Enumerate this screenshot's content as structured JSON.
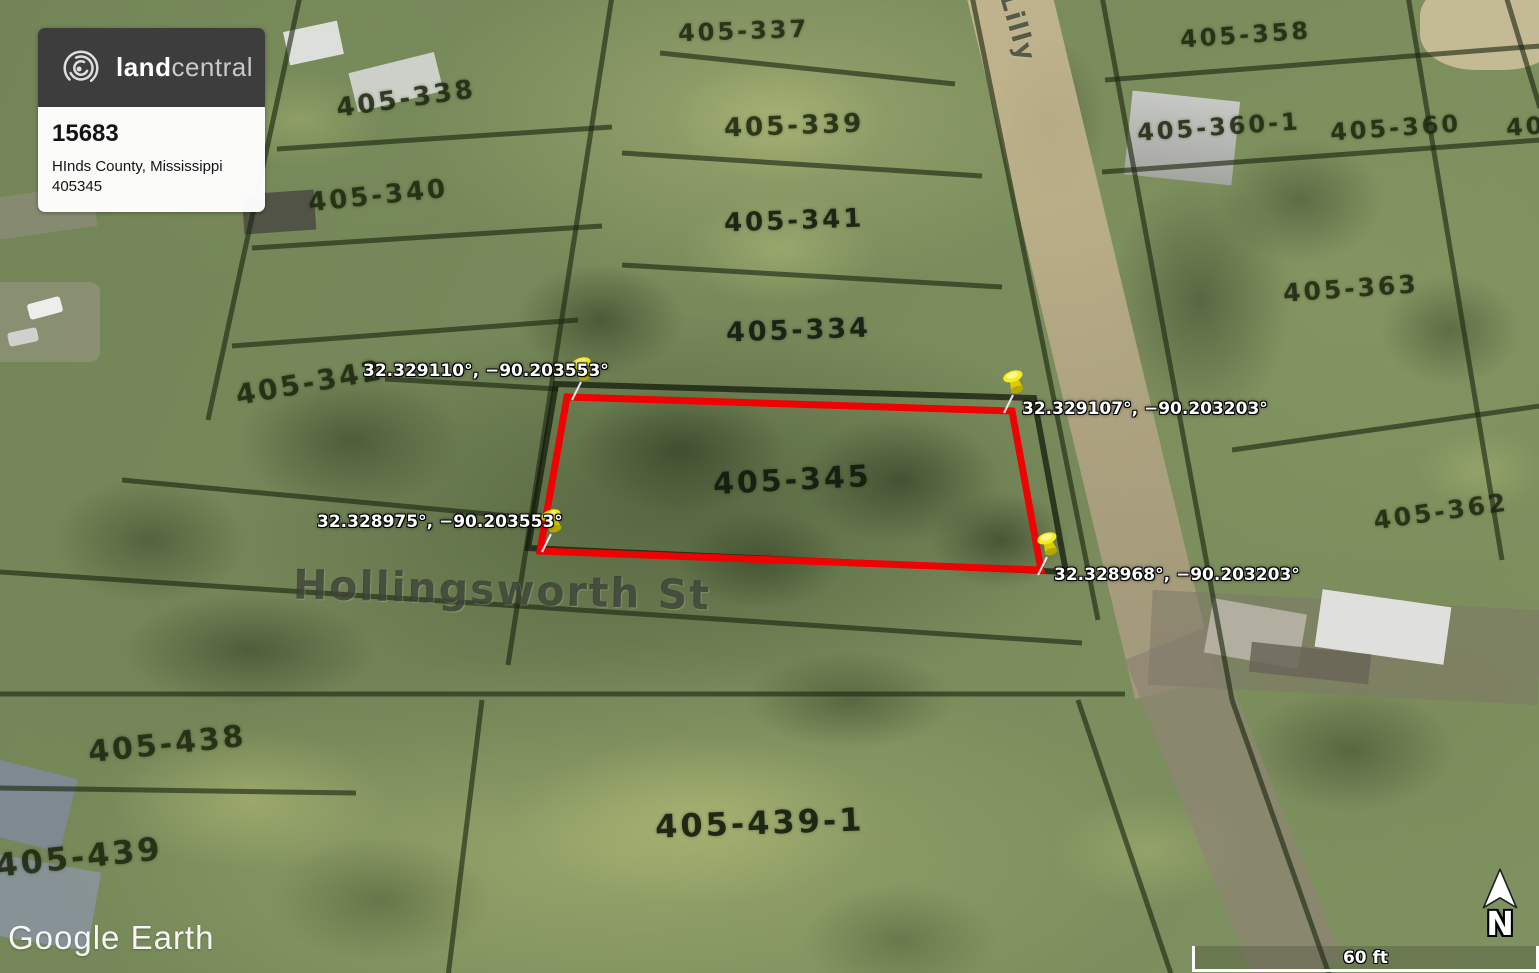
{
  "branding_card": {
    "logo_bold": "land",
    "logo_light": "central",
    "listing_id": "15683",
    "location": "HInds County, Mississippi",
    "apn": "405345"
  },
  "pins": [
    {
      "position": "top-left",
      "coords": "32.329110°, −90.203553°"
    },
    {
      "position": "top-right",
      "coords": "32.329107°, −90.203203°"
    },
    {
      "position": "bottom-left",
      "coords": "32.328975°, −90.203553°"
    },
    {
      "position": "bottom-right",
      "coords": "32.328968°, −90.203203°"
    }
  ],
  "subject_parcel": {
    "label": "405-345"
  },
  "parcels": [
    {
      "label": "405-337"
    },
    {
      "label": "405-338"
    },
    {
      "label": "405-339"
    },
    {
      "label": "405-340"
    },
    {
      "label": "405-341"
    },
    {
      "label": "405-334"
    },
    {
      "label": "405-342"
    },
    {
      "label": "405-345"
    },
    {
      "label": "405-358"
    },
    {
      "label": "405-360-1"
    },
    {
      "label": "405-360"
    },
    {
      "label": "405-363"
    },
    {
      "label": "405-362"
    },
    {
      "label": "405-438"
    },
    {
      "label": "405-439"
    },
    {
      "label": "405-439-1"
    },
    {
      "label": "405"
    }
  ],
  "streets": {
    "hollingsworth": "Hollingsworth St",
    "lilly": "Lilly"
  },
  "watermark": "Google Earth",
  "scale_label": "60 ft",
  "compass_label": "N",
  "colors": {
    "subject_outline_red": "#ee0202",
    "pin_yellow": "#f6ec1e",
    "card_header_gray": "#3d3d3d"
  }
}
